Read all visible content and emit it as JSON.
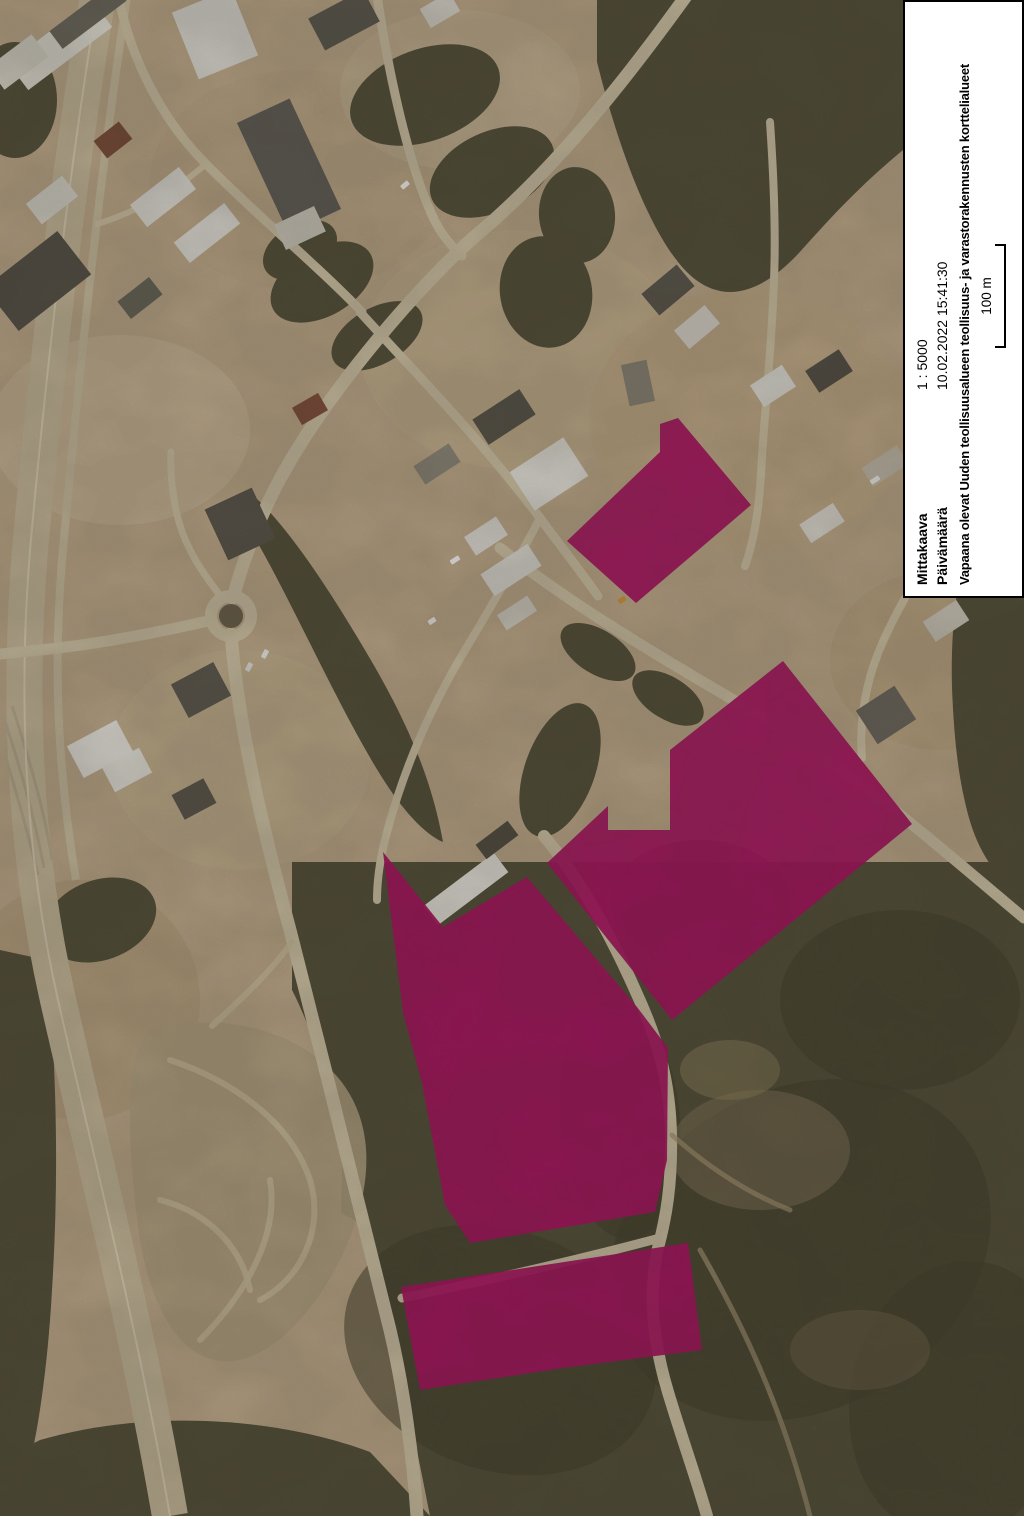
{
  "panel": {
    "rows": [
      {
        "label": "Mittakaava",
        "value": "1 : 5000"
      },
      {
        "label": "Päivämäärä",
        "value": "10.02.2022 15:41:30"
      }
    ],
    "description": "Vapaana olevat Uuden teollisuusalueen teollisuus- ja varastorakennusten korttelialueet",
    "scale_bar_label": "100 m",
    "background": "#ffffff",
    "border_color": "#000000"
  },
  "map": {
    "width": 1024,
    "height": 1516,
    "highlight_opacity": 0.94,
    "colors": {
      "base": "#c7b191",
      "road": "#d9ccae",
      "highway": "#cfc1a2",
      "highway_line": "#e8dec6",
      "forest": "#56523c",
      "forest_dark": "#46422d",
      "gravel": "#b9a988",
      "trail": "#d3c5a5",
      "highlight": "#b01166",
      "roundabout_island": "#6f6450"
    },
    "terrain_patches": [
      [
        120,
        430,
        130,
        95,
        "#d0bd9d",
        0.9
      ],
      [
        300,
        180,
        150,
        110,
        "#c3ad8c",
        0.7
      ],
      [
        520,
        350,
        160,
        120,
        "#cbb795",
        0.6
      ],
      [
        750,
        420,
        160,
        130,
        "#c9b28f",
        0.8
      ],
      [
        940,
        660,
        110,
        90,
        "#c2ab87",
        0.8
      ],
      [
        240,
        760,
        130,
        110,
        "#ccb896",
        0.7
      ],
      [
        80,
        1000,
        120,
        120,
        "#baa27e",
        0.5
      ],
      [
        460,
        90,
        120,
        80,
        "#cdbb9c",
        0.6
      ]
    ],
    "forests": [
      {
        "d": "M 597,0 L 903,0 L 903,150 C 852,192 820,230 798,254 C 760,294 726,302 696,280 C 656,250 620,155 597,62 Z"
      },
      {
        "d": "M 957,593 L 1024,593 L 1024,895 C 998,880 980,856 969,818 C 958,778 954,738 952,688 C 951,653 953,620 957,593 Z"
      },
      {
        "d": "M 292,862 L 1024,862 L 1024,1516 L 430,1516 C 394,1332 341,1085 292,990 Z"
      },
      {
        "d": "M 256,498 C 290,530 330,590 372,662 C 408,724 432,780 443,842 C 420,832 394,800 368,754 C 330,688 288,595 256,540 Z"
      },
      {
        "d": "M 350,872 L 396,880 L 382,1235 L 341,1213 Z"
      },
      {
        "d": "M 0,950 L 46,960 C 57,1062 59,1180 52,1290 C 46,1398 30,1478 14,1516 L 0,1516 Z"
      },
      {
        "d": "M 40,1440 C 150,1408 280,1418 370,1452 L 430,1516 L 0,1516 L 0,1460 Z"
      },
      {
        "e": [
          598,
          652,
          42,
          22,
          32
        ]
      },
      {
        "e": [
          668,
          698,
          40,
          21,
          32
        ]
      },
      {
        "e": [
          425,
          95,
          78,
          46,
          -20
        ]
      },
      {
        "e": [
          492,
          172,
          66,
          40,
          -25
        ]
      },
      {
        "e": [
          322,
          282,
          56,
          34,
          -30
        ]
      },
      {
        "e": [
          377,
          336,
          50,
          28,
          -30
        ]
      },
      {
        "e": [
          546,
          292,
          46,
          56,
          -10
        ]
      },
      {
        "e": [
          577,
          215,
          38,
          48,
          -5
        ]
      },
      {
        "e": [
          300,
          250,
          40,
          26,
          -30
        ]
      },
      {
        "e": [
          100,
          920,
          58,
          40,
          -20
        ]
      },
      {
        "e": [
          15,
          100,
          42,
          58,
          0
        ]
      },
      {
        "e": [
          560,
          770,
          35,
          70,
          20
        ]
      }
    ],
    "forest_accents": [
      [
        800,
        1250,
        200,
        160,
        -30
      ],
      [
        500,
        1350,
        160,
        120,
        20
      ],
      [
        900,
        1000,
        120,
        90,
        0
      ],
      [
        700,
        900,
        90,
        60,
        0
      ],
      [
        960,
        1400,
        110,
        140,
        10
      ],
      [
        620,
        1120,
        60,
        120,
        -5
      ]
    ],
    "clearings": [
      [
        760,
        1150,
        90,
        60,
        "#8a7c5e",
        0.5
      ],
      [
        860,
        1350,
        70,
        40,
        "#7c6f52",
        0.4
      ],
      [
        730,
        1070,
        50,
        30,
        "#93855f",
        0.5
      ]
    ],
    "gravel": {
      "base": "M 150,1030 C 220,1010 300,1030 340,1080 C 380,1130 370,1200 340,1260 C 310,1320 260,1370 215,1360 C 175,1352 150,1300 140,1240 C 130,1170 120,1060 150,1030 Z",
      "trails": [
        "M 170,1060 C 230,1080 290,1120 310,1180 C 325,1230 300,1280 260,1300",
        "M 200,1340 C 240,1300 280,1240 270,1180",
        "M 160,1200 C 200,1210 240,1240 250,1290",
        "M 292,942 C 268,975 240,1000 212,1026"
      ]
    },
    "forest_trails": [
      "M 700,1250 C 740,1320 780,1400 810,1516",
      "M 672,1135 C 700,1160 740,1190 790,1210"
    ],
    "highway": {
      "band": {
        "d": "M 99,-10 C 72,150 48,350 30,550 C 18,700 24,850 58,1000 C 92,1150 138,1330 170,1516",
        "w": 36
      },
      "center_line": {
        "d": "M 99,-10 C 72,150 48,350 30,550 C 18,700 24,850 58,1000 C 92,1150 138,1330 170,1516",
        "w": 2
      },
      "service": {
        "d": "M 128,-10 C 102,160 80,360 62,560 C 54,660 56,760 76,880",
        "w": 8
      },
      "sidings": [
        "M 2,712 C 18,760 34,815 44,868",
        "M -6,720 C 10,770 26,825 38,875",
        "M 12,706 C 28,755 44,808 52,860"
      ]
    },
    "roads": [
      {
        "name": "road-main-northeast",
        "d": "M 689,-8 C 640,60 565,160 480,232 C 420,283 330,390 285,470 C 262,510 243,560 233,598",
        "w": 13
      },
      {
        "name": "road-south",
        "d": "M 231,634 C 237,710 255,800 290,930 C 325,1065 352,1180 390,1330 C 403,1385 413,1455 417,1516",
        "w": 13
      },
      {
        "name": "road-west",
        "d": "M 212,620 C 160,632 100,644 40,650 L 0,654",
        "w": 11
      },
      {
        "name": "road-northwest-small",
        "d": "M 222,598 C 196,565 182,540 176,510 C 172,490 170,470 171,452",
        "w": 7
      },
      {
        "name": "road-north-branch",
        "d": "M 377,-5 C 388,70 407,160 432,215 C 441,235 452,247 462,256",
        "w": 9
      },
      {
        "name": "road-east-local",
        "d": "M 770,122 C 774,180 776,230 774,280 C 772,340 766,400 762,455 C 760,500 756,535 745,566",
        "w": 8
      },
      {
        "name": "road-southeast",
        "d": "M 500,548 C 565,600 645,648 725,695 C 805,742 868,788 925,835 C 965,868 1000,898 1024,918",
        "w": 11
      },
      {
        "name": "road-industrial-diagonal",
        "d": "M 360,312 C 420,378 478,436 540,518 C 560,545 578,568 598,596",
        "w": 9
      },
      {
        "name": "road-west-of-areas",
        "d": "M 540,518 C 518,560 488,612 458,662 C 428,714 403,772 387,832 C 380,858 377,880 377,900",
        "w": 8
      },
      {
        "name": "road-between-areas",
        "d": "M 544,836 C 574,872 605,922 636,992 C 660,1044 670,1085 671,1135 C 672,1185 666,1218 658,1248 C 648,1292 653,1342 668,1392 C 683,1442 697,1480 707,1516",
        "w": 12
      },
      {
        "name": "trail-gap",
        "d": "M 660,1238 C 570,1262 480,1282 402,1298",
        "w": 9
      },
      {
        "name": "road-farm-drive",
        "d": "M 905,598 C 890,625 875,655 868,685 C 862,710 860,735 862,758",
        "w": 8
      },
      {
        "name": "road-topleft-local",
        "d": "M 118,-6 C 130,58 162,120 206,164 C 254,213 318,266 362,312",
        "w": 9
      },
      {
        "name": "road-topleft-spur",
        "d": "M 206,164 C 176,190 140,210 98,224",
        "w": 6
      }
    ],
    "roundabout": {
      "cx": 231,
      "cy": 616,
      "r_ring": 20,
      "ring_w": 12,
      "r_island": 12
    },
    "buildings": [
      [
        60,
        45,
        105,
        34,
        -37,
        "#e8e5dc"
      ],
      [
        88,
        16,
        80,
        22,
        -37,
        "#6e6a60"
      ],
      [
        18,
        62,
        55,
        28,
        -37,
        "#dedacf"
      ],
      [
        215,
        34,
        64,
        72,
        -22,
        "#e6e4dd"
      ],
      [
        344,
        20,
        62,
        36,
        -28,
        "#5f5b52"
      ],
      [
        289,
        166,
        58,
        122,
        -25,
        "#63605a"
      ],
      [
        300,
        228,
        44,
        28,
        -25,
        "#d8d4c9"
      ],
      [
        163,
        197,
        62,
        28,
        -38,
        "#e7e5de"
      ],
      [
        207,
        233,
        64,
        26,
        -38,
        "#e7e5de"
      ],
      [
        52,
        200,
        46,
        26,
        -38,
        "#e2dfd6"
      ],
      [
        113,
        140,
        32,
        22,
        -38,
        "#7d4f3c"
      ],
      [
        38,
        281,
        92,
        55,
        -38,
        "#57534a"
      ],
      [
        140,
        298,
        40,
        22,
        -38,
        "#6b675e"
      ],
      [
        504,
        417,
        56,
        30,
        -33,
        "#5a564d"
      ],
      [
        549,
        474,
        64,
        46,
        -33,
        "#eceae3"
      ],
      [
        437,
        464,
        42,
        22,
        -33,
        "#918b7e"
      ],
      [
        486,
        536,
        38,
        22,
        -33,
        "#e8e6df"
      ],
      [
        511,
        570,
        56,
        26,
        -33,
        "#e8e6df"
      ],
      [
        517,
        613,
        36,
        18,
        -33,
        "#dcd8cd"
      ],
      [
        668,
        290,
        46,
        28,
        -40,
        "#5d594f"
      ],
      [
        697,
        327,
        40,
        24,
        -40,
        "#e5e2da"
      ],
      [
        638,
        383,
        26,
        42,
        -12,
        "#8e887b"
      ],
      [
        773,
        386,
        38,
        26,
        -33,
        "#e7e5de"
      ],
      [
        829,
        371,
        40,
        26,
        -33,
        "#56524a"
      ],
      [
        885,
        466,
        42,
        22,
        -33,
        "#c9c1b1"
      ],
      [
        822,
        523,
        40,
        22,
        -33,
        "#e4e1d9"
      ],
      [
        240,
        524,
        52,
        56,
        -25,
        "#5b574e"
      ],
      [
        201,
        690,
        48,
        38,
        -28,
        "#5f5b52"
      ],
      [
        100,
        749,
        56,
        36,
        -28,
        "#efede7"
      ],
      [
        127,
        770,
        42,
        28,
        -28,
        "#eceae2"
      ],
      [
        194,
        799,
        36,
        28,
        -28,
        "#5d594f"
      ],
      [
        886,
        715,
        46,
        40,
        -33,
        "#6e6960"
      ],
      [
        946,
        621,
        40,
        24,
        -33,
        "#d5cfc2"
      ],
      [
        466,
        889,
        88,
        24,
        -37,
        "#efede6"
      ],
      [
        497,
        840,
        40,
        18,
        -37,
        "#534f44"
      ],
      [
        310,
        409,
        30,
        20,
        -30,
        "#84503e"
      ],
      [
        440,
        10,
        34,
        22,
        -30,
        "#e3e0d7"
      ]
    ],
    "vehicles": [
      [
        455,
        560,
        10,
        5,
        -33,
        "#ffffff"
      ],
      [
        265,
        654,
        9,
        5,
        -62,
        "#f2f2f0"
      ],
      [
        249,
        667,
        9,
        5,
        -62,
        "#e8e8e4"
      ],
      [
        405,
        185,
        9,
        5,
        -40,
        "#ffffff"
      ],
      [
        622,
        600,
        8,
        5,
        -33,
        "#d49a3a"
      ],
      [
        875,
        480,
        10,
        5,
        -33,
        "#f4f4f2"
      ],
      [
        432,
        621,
        8,
        5,
        -33,
        "#fafaf8"
      ],
      [
        588,
        545,
        8,
        4,
        -33,
        "#ffffff"
      ]
    ],
    "highlighted_areas": [
      {
        "name": "north",
        "points": [
          [
            660,
            424
          ],
          [
            678,
            418
          ],
          [
            751,
            505
          ],
          [
            703,
            546
          ],
          [
            636,
            603
          ],
          [
            567,
            541
          ],
          [
            660,
            452
          ]
        ]
      },
      {
        "name": "east-large",
        "points": [
          [
            783,
            661
          ],
          [
            912,
            824
          ],
          [
            672,
            1020
          ],
          [
            547,
            863
          ],
          [
            608,
            806
          ],
          [
            608,
            830
          ],
          [
            670,
            830
          ],
          [
            670,
            750
          ]
        ]
      },
      {
        "name": "central-large",
        "points": [
          [
            383,
            852
          ],
          [
            443,
            927
          ],
          [
            527,
            877
          ],
          [
            637,
            1007
          ],
          [
            668,
            1048
          ],
          [
            667,
            1160
          ],
          [
            655,
            1212
          ],
          [
            470,
            1243
          ],
          [
            445,
            1205
          ],
          [
            422,
            1083
          ],
          [
            403,
            1012
          ]
        ]
      },
      {
        "name": "south-strip",
        "points": [
          [
            401,
            1287
          ],
          [
            688,
            1243
          ],
          [
            702,
            1350
          ],
          [
            563,
            1368
          ],
          [
            420,
            1390
          ]
        ]
      }
    ]
  }
}
